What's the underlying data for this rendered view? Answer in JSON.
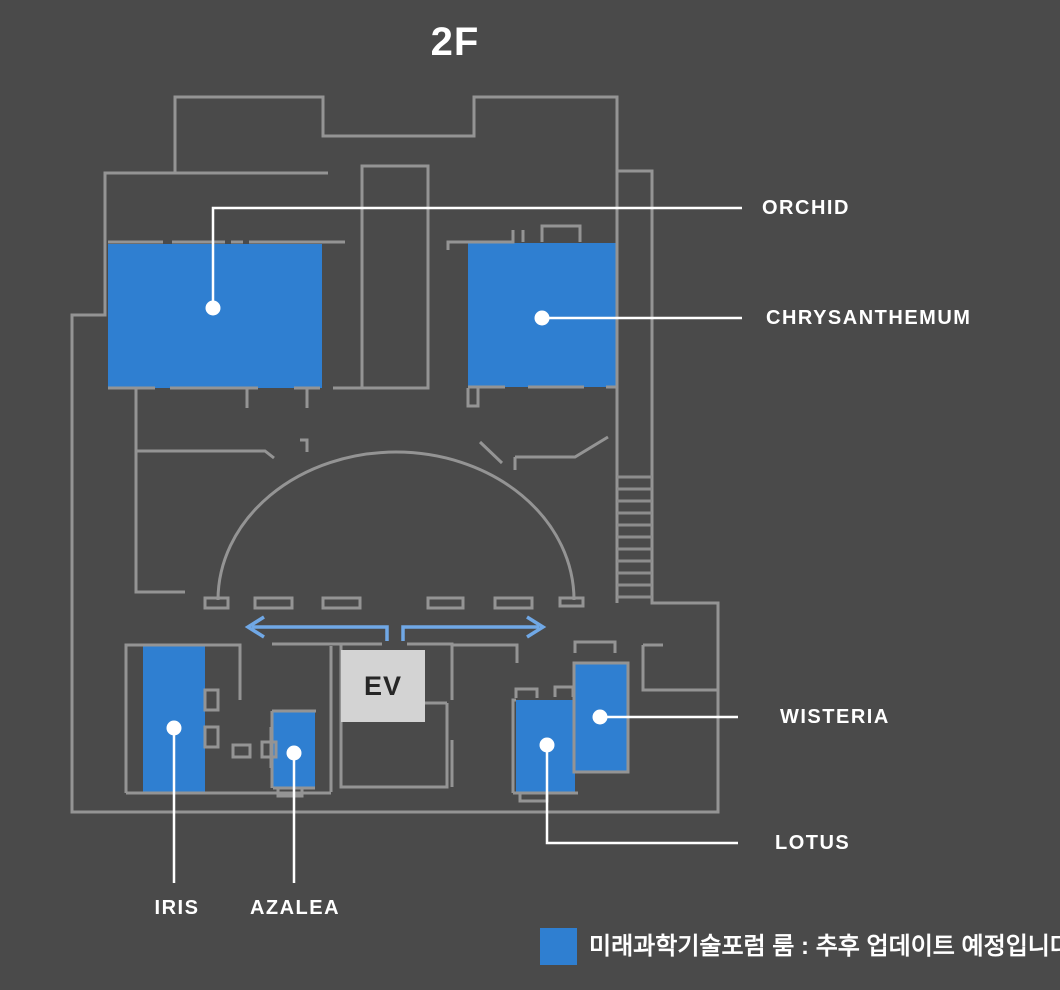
{
  "title": "2F",
  "colors": {
    "background": "#4a4a4a",
    "wall": "#949494",
    "room_fill": "#2f7fd1",
    "arrow": "#70a8e6",
    "leader_line": "#ffffff",
    "elevator_fill": "#d3d3d3",
    "elevator_text": "#262626",
    "label_text": "#ffffff"
  },
  "rooms": [
    {
      "id": "orchid",
      "label": "ORCHID"
    },
    {
      "id": "chrysanthemum",
      "label": "CHRYSANTHEMUM"
    },
    {
      "id": "wisteria",
      "label": "WISTERIA"
    },
    {
      "id": "lotus",
      "label": "LOTUS"
    },
    {
      "id": "iris",
      "label": "IRIS"
    },
    {
      "id": "azalea",
      "label": "AZALEA"
    }
  ],
  "elevator": {
    "label": "EV"
  },
  "legend": {
    "swatch_color": "#2f7fd1",
    "text": "미래과학기술포럼 룸 : 추후 업데이트 예정입니다."
  }
}
